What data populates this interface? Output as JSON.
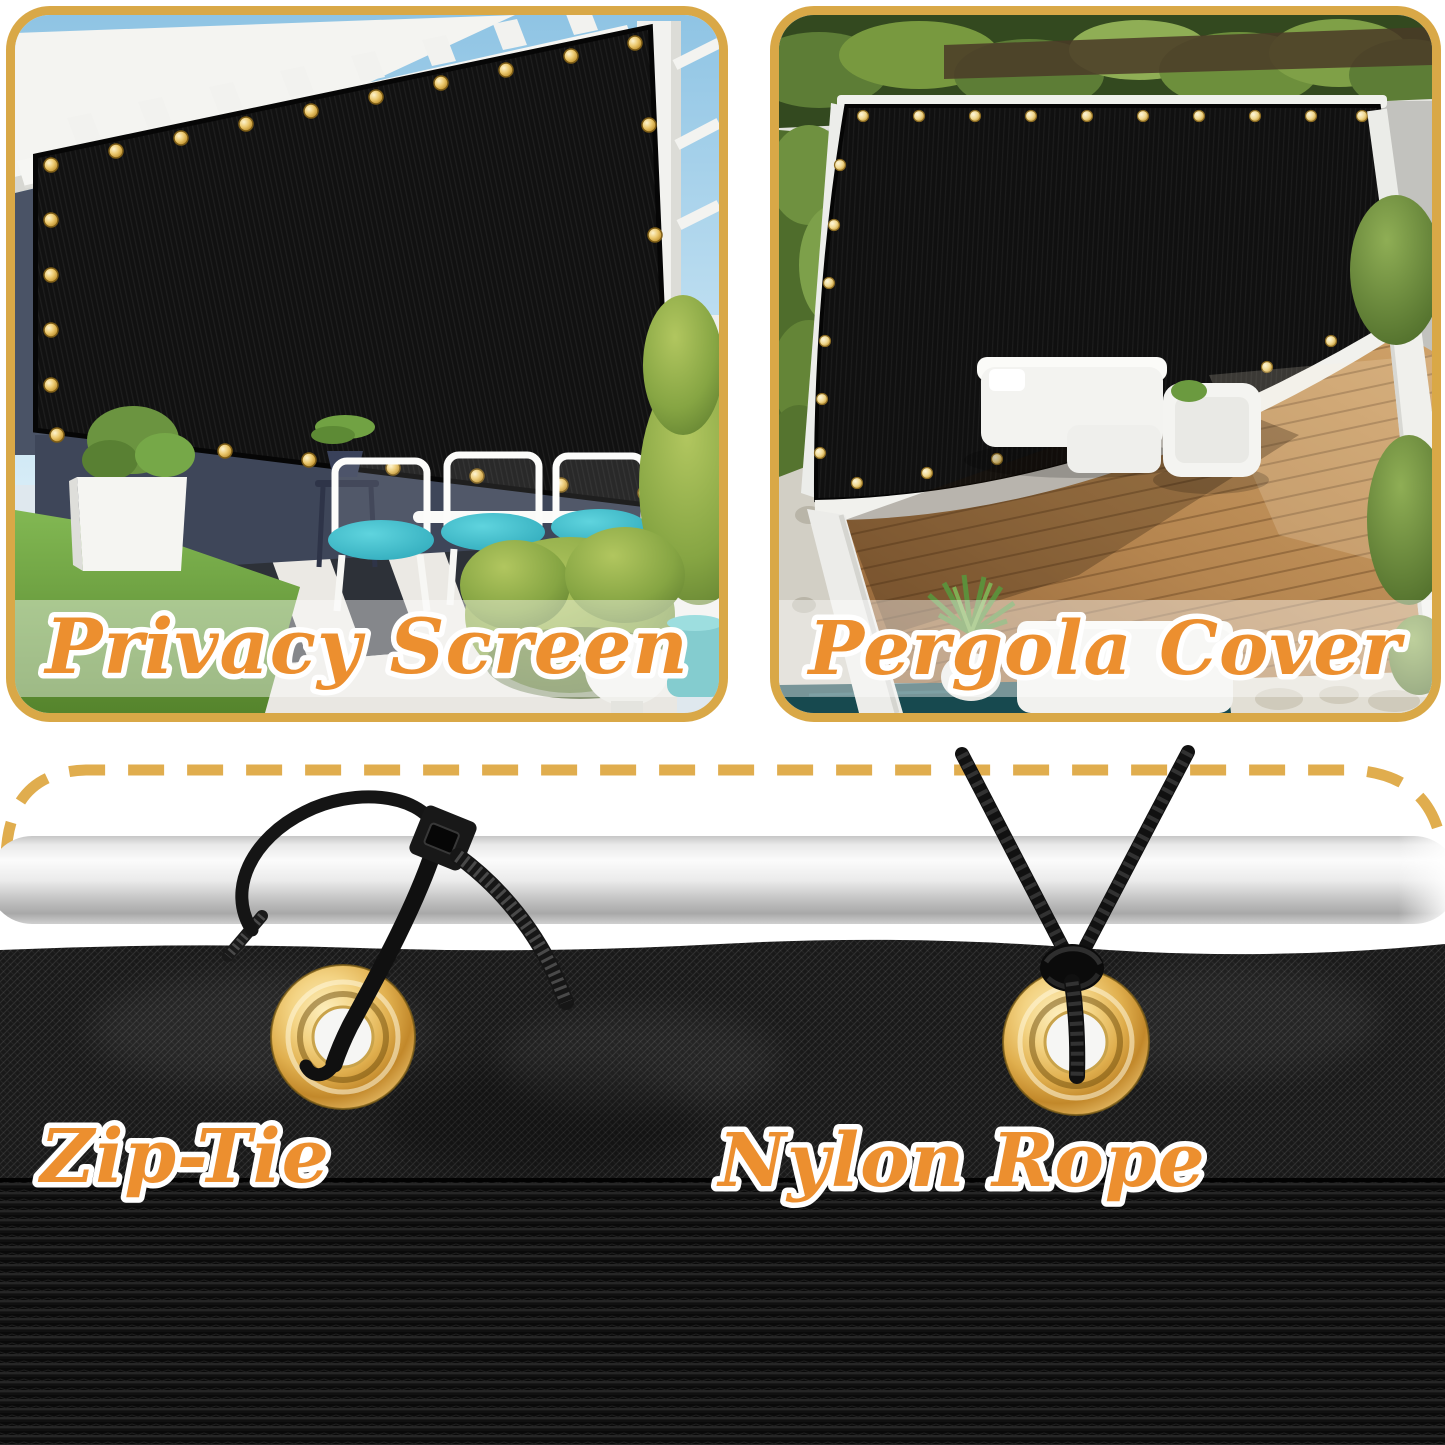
{
  "panels": [
    {
      "id": "privacy-screen",
      "caption": "Privacy Screen"
    },
    {
      "id": "pergola-cover",
      "caption": "Pergola Cover"
    }
  ],
  "installation": [
    {
      "id": "zip-tie",
      "caption": "Zip-Tie"
    },
    {
      "id": "nylon-rope",
      "caption": "Nylon Rope"
    }
  ],
  "icons": {
    "grommet": "brass-grommet-icon",
    "zip_tie": "zip-tie-icon",
    "rope": "nylon-rope-icon",
    "pole": "mounting-pole",
    "dashed_border": "dashed-outline"
  },
  "colors": {
    "frame_gold": "#D9A847",
    "dash_gold": "#E0AD4E",
    "caption_fill": "#EC8F2F",
    "caption_outline": "#FFFFFF",
    "mesh_black": "#141414",
    "grommet_brass": "#E0AF4E",
    "cushion_teal": "#3FC3CF",
    "sky_blue": "#A9D2EB",
    "grass_green": "#6FA743",
    "deck_wood": "#B08552",
    "pool_teal": "#17494F"
  }
}
